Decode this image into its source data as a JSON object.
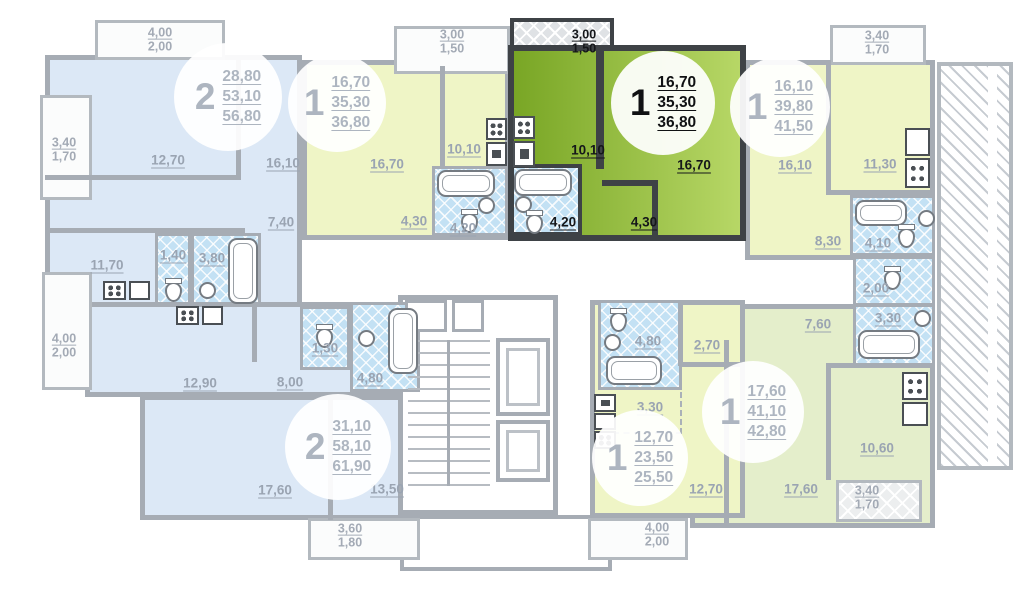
{
  "colors": {
    "wall": "#a6acb4",
    "wall_selected": "#3e4246",
    "fill_blue": "#dce8f6",
    "fill_yellow": "#eff5c6",
    "fill_green": "#e4eecb",
    "highlight_from": "#79a625",
    "highlight_to": "#b7d766",
    "wet_blue": "#c3e1f4"
  },
  "apartments": {
    "top_left": {
      "type": "2",
      "areas": [
        "28,80",
        "53,10",
        "56,80"
      ],
      "rooms": {
        "bedroom": "12,70",
        "living": "16,10",
        "hall": "7,40",
        "kitchen": "11,70",
        "wc": "1,40",
        "bath": "3,80"
      },
      "balcony_top": [
        "4,00",
        "2,00"
      ],
      "balcony_left": [
        "3,40",
        "1,70"
      ]
    },
    "top_mid": {
      "type": "1",
      "areas": [
        "16,70",
        "35,30",
        "36,80"
      ],
      "rooms": {
        "living": "16,70",
        "kitchen": "10,10",
        "hall": "4,30",
        "bath": "4,20"
      },
      "balcony": [
        "3,00",
        "1,50"
      ]
    },
    "selected": {
      "type": "1",
      "areas": [
        "16,70",
        "35,30",
        "36,80"
      ],
      "rooms": {
        "living": "16,70",
        "kitchen": "10,10",
        "hall": "4,30",
        "bath": "4,20"
      },
      "balcony": [
        "3,00",
        "1,50"
      ]
    },
    "top_right": {
      "type": "1",
      "areas": [
        "16,10",
        "39,80",
        "41,50"
      ],
      "rooms": {
        "living": "16,10",
        "kitchen": "11,30",
        "hall": "8,30",
        "bath": "4,10"
      },
      "balcony": [
        "3,40",
        "1,70"
      ]
    },
    "bottom_right": {
      "type": "1",
      "areas": [
        "17,60",
        "41,10",
        "42,80"
      ],
      "rooms": {
        "living": "17,60",
        "kitchen": "10,60",
        "hall": "7,60",
        "bath": "3,30",
        "wc": "2,00"
      },
      "balcony": [
        "3,40",
        "1,70"
      ]
    },
    "bottom_mid": {
      "type": "1",
      "areas": [
        "12,70",
        "23,50",
        "25,50"
      ],
      "rooms": {
        "living": "12,70",
        "kitchen": "3,30",
        "hall": "2,70",
        "bath": "4,80"
      },
      "balcony": [
        "4,00",
        "2,00"
      ]
    },
    "bottom_left": {
      "type": "2",
      "areas": [
        "31,10",
        "58,10",
        "61,90"
      ],
      "rooms": {
        "kitchen": "12,90",
        "hall": "8,00",
        "living": "17,60",
        "bedroom": "13,50",
        "wc": "1,30",
        "bath": "4,80"
      },
      "balcony_left": [
        "4,00",
        "2,00"
      ],
      "balcony_bottom": [
        "3,60",
        "1,80"
      ]
    }
  }
}
